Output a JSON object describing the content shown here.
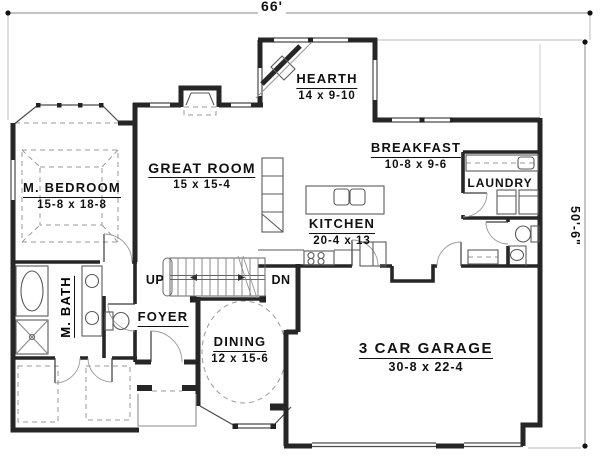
{
  "plan": {
    "dimensions": {
      "top_width": "66'",
      "right_height": "50'-6\""
    },
    "rooms": {
      "master_bedroom": {
        "name": "M. BEDROOM",
        "dims": "15-8 x 18-8"
      },
      "master_bath": {
        "name": "M. BATH"
      },
      "great_room": {
        "name": "GREAT ROOM",
        "dims": "15 x 15-4"
      },
      "hearth": {
        "name": "HEARTH",
        "dims": "14 x 9-10"
      },
      "breakfast": {
        "name": "BREAKFAST",
        "dims": "10-8 x 9-6"
      },
      "laundry": {
        "name": "LAUNDRY"
      },
      "kitchen": {
        "name": "KITCHEN",
        "dims": "20-4 x 13"
      },
      "foyer": {
        "name": "FOYER"
      },
      "dining": {
        "name": "DINING",
        "dims": "12 x 15-6"
      },
      "garage": {
        "name": "3 CAR GARAGE",
        "dims": "30-8 x 22-4"
      }
    },
    "stairs": {
      "up_label": "UP",
      "down_label": "DN"
    },
    "colors": {
      "walls": "#262626",
      "thin_lines": "#555555",
      "dashed_lines": "#9a9a9a",
      "text": "#111111",
      "background": "#ffffff"
    }
  }
}
